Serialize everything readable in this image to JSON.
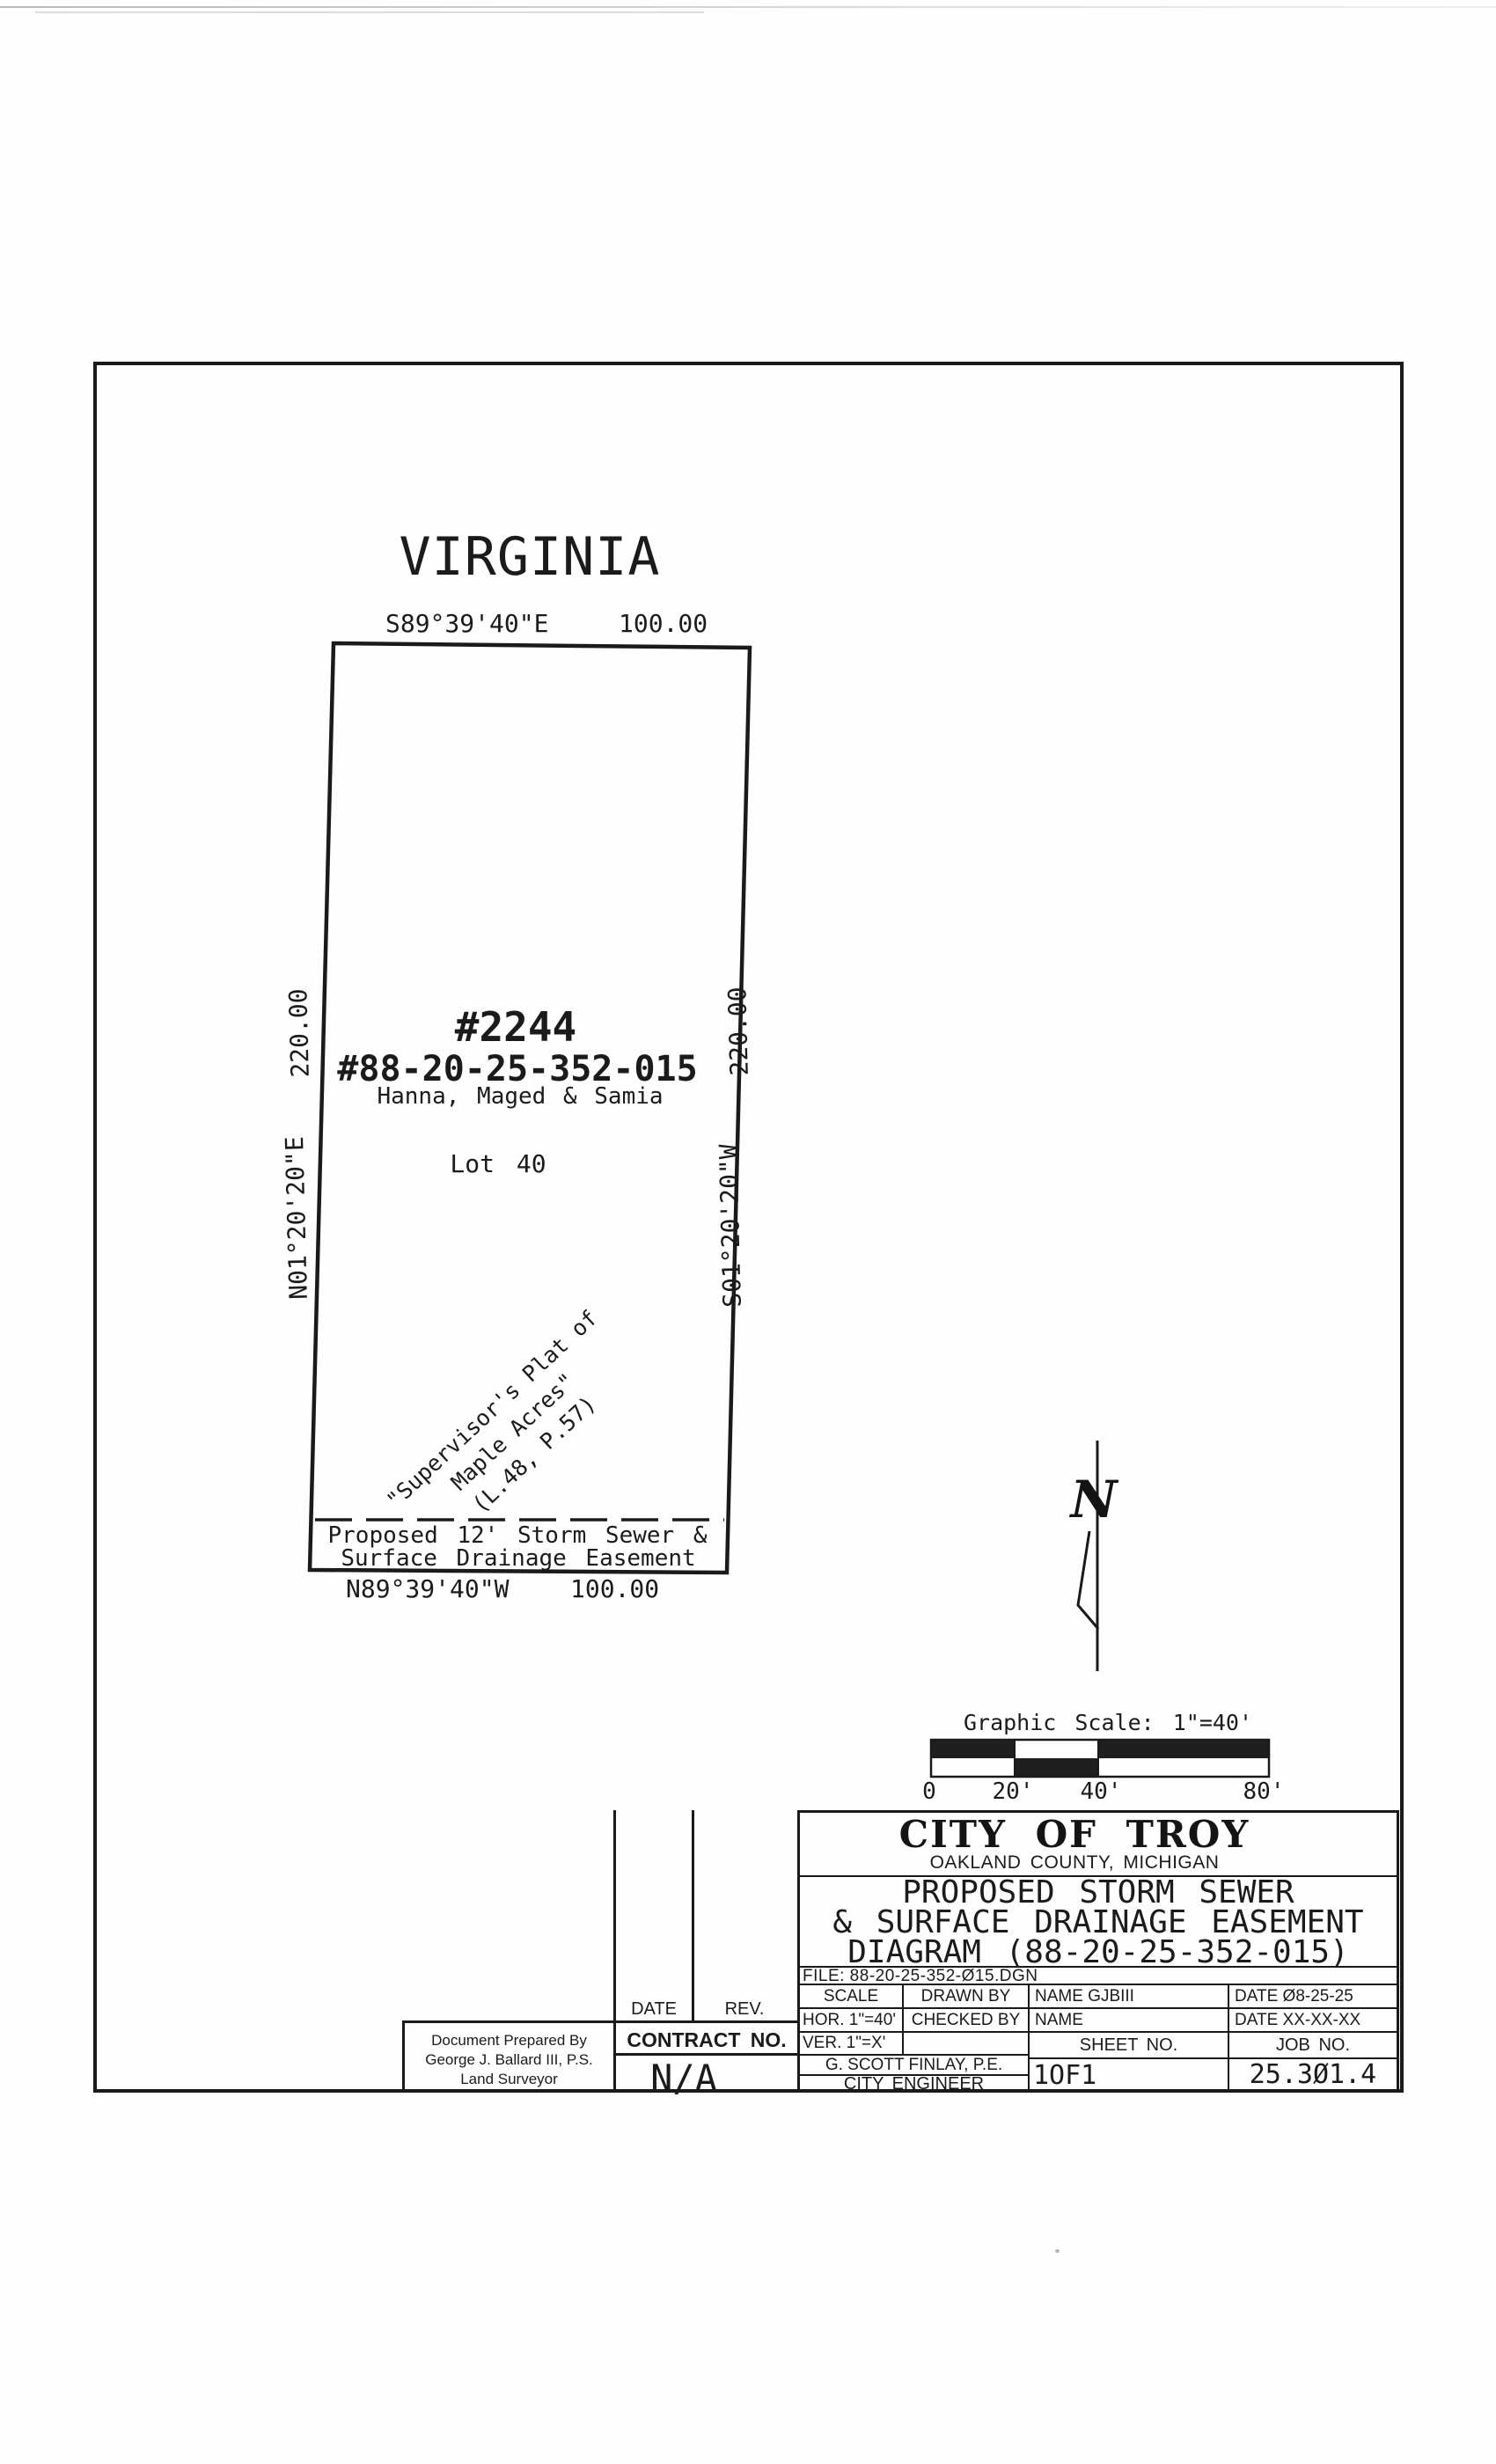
{
  "drawing": {
    "street_name": "VIRGINIA",
    "north_label": "N",
    "parcel": {
      "top_bearing": "S89°39'40\"E",
      "top_distance": "100.00",
      "bottom_bearing": "N89°39'40\"W",
      "bottom_distance": "100.00",
      "west_distance": "220.00",
      "west_bearing": "N01°20'20\"E",
      "east_distance": "220.00",
      "east_bearing": "S01°20'20\"W",
      "house_number": "#2244",
      "parcel_number": "#88-20-25-352-015",
      "owner": "Hanna, Maged & Samia",
      "lot_label": "Lot 40",
      "plat_reference": {
        "line1": "\"Supervisor's Plat of",
        "line2": "Maple Acres\"",
        "line3": "(L.48, P.57)"
      },
      "easement_label": {
        "line1": "Proposed 12' Storm Sewer &",
        "line2": "Surface Drainage Easement"
      }
    },
    "graphic_scale": {
      "title": "Graphic Scale: 1\"=40'",
      "ticks": [
        "0",
        "20'",
        "40'",
        "80'"
      ]
    }
  },
  "title_block": {
    "agency": "CITY OF TROY",
    "county": "OAKLAND COUNTY, MICHIGAN",
    "sheet_title": {
      "line1": "PROPOSED STORM SEWER",
      "line2": "& SURFACE DRAINAGE EASEMENT",
      "line3": "DIAGRAM (88-20-25-352-015)"
    },
    "file_label": "FILE: 88-20-25-352-Ø15.DGN",
    "scale_label": "SCALE",
    "hor_scale": "HOR. 1\"=40'",
    "ver_scale": "VER. 1\"=X'",
    "drawn_by_label": "DRAWN BY",
    "drawn_by_name": "NAME GJBIII",
    "drawn_by_date": "DATE Ø8-25-25",
    "checked_by_label": "CHECKED BY",
    "checked_by_name": "NAME",
    "checked_by_date": "DATE XX-XX-XX",
    "sheet_no_label": "SHEET NO.",
    "sheet_no": "1OF1",
    "job_no_label": "JOB NO.",
    "job_no": "25.3Ø1.4",
    "engineer": "G. SCOTT FINLAY, P.E.",
    "engineer_title": "CITY ENGINEER"
  },
  "revision_block": {
    "date_label": "DATE",
    "rev_label": "REV.",
    "contract_label": "CONTRACT NO.",
    "contract_value": "N/A"
  },
  "prepared_by": {
    "line1": "Document Prepared By",
    "line2": "George J. Ballard III, P.S.",
    "line3": "Land Surveyor"
  }
}
